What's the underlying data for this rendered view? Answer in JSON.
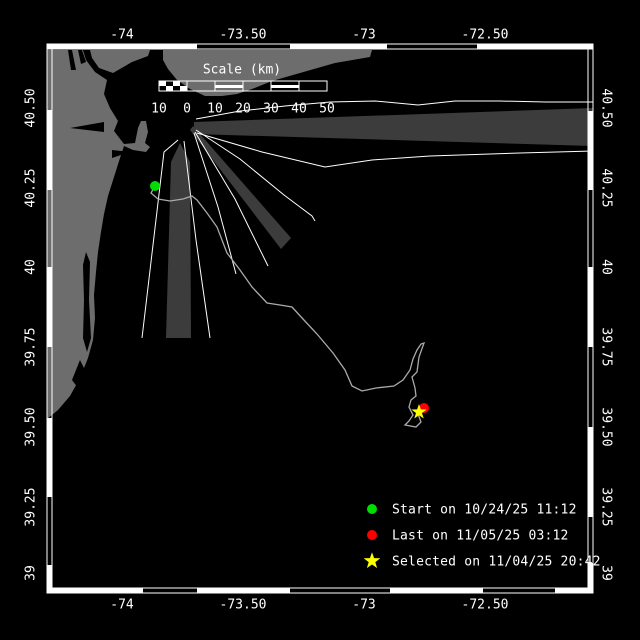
{
  "window": {
    "description": "Track map with radar coverage fan, scale bar and start/last/selected markers"
  },
  "colors": {
    "background": "#000000",
    "land": "#6d6d6d",
    "beam_gray": "#3c3c3c",
    "track_gray": "#aaaaaa",
    "frame_white": "#ffffff",
    "text_white": "#ffffff",
    "start_green": "#00dd00",
    "last_red": "#ff0000",
    "selected_yellow": "#ffff00"
  },
  "axes": {
    "lon_labels": [
      "-74",
      "-73.50",
      "-73",
      "-72.50"
    ],
    "lon_x": [
      122,
      243,
      364,
      485
    ],
    "lat_labels": [
      "40.50",
      "40.25",
      "40",
      "39.75",
      "39.50",
      "39.25",
      "39"
    ],
    "lat_y": [
      108,
      188,
      267,
      347,
      427,
      507,
      573
    ]
  },
  "scalebar": {
    "title": "Scale (km)",
    "tick_labels": [
      "10",
      "0",
      "10",
      "20",
      "30",
      "40",
      "50"
    ],
    "tick_x": [
      159,
      187,
      215,
      243,
      271,
      299,
      327
    ]
  },
  "legend": {
    "items": [
      {
        "marker": "start-dot",
        "color": "#00dd00",
        "label": "Start on 10/24/25 11:12"
      },
      {
        "marker": "last-dot",
        "color": "#ff0000",
        "label": "Last on 11/05/25 03:12"
      },
      {
        "marker": "selected-star",
        "color": "#ffff00",
        "label": "Selected on 11/04/25 20:42"
      }
    ]
  },
  "markers": {
    "start": {
      "x": 155,
      "y": 186
    },
    "last": {
      "x": 424,
      "y": 408
    },
    "selected": {
      "x": 419,
      "y": 412
    }
  },
  "track": {
    "points": [
      [
        155,
        186
      ],
      [
        151,
        193
      ],
      [
        158,
        199
      ],
      [
        170,
        201
      ],
      [
        183,
        199
      ],
      [
        192,
        196
      ],
      [
        197,
        200
      ],
      [
        207,
        213
      ],
      [
        217,
        227
      ],
      [
        227,
        253
      ],
      [
        240,
        270
      ],
      [
        252,
        287
      ],
      [
        267,
        303
      ],
      [
        280,
        305
      ],
      [
        292,
        307
      ],
      [
        303,
        319
      ],
      [
        317,
        334
      ],
      [
        333,
        353
      ],
      [
        345,
        370
      ],
      [
        352,
        386
      ],
      [
        362,
        391
      ],
      [
        376,
        388
      ],
      [
        394,
        386
      ],
      [
        403,
        380
      ],
      [
        410,
        370
      ],
      [
        413,
        359
      ],
      [
        417,
        350
      ],
      [
        421,
        344
      ],
      [
        424,
        343
      ],
      [
        419,
        357
      ],
      [
        417,
        372
      ],
      [
        412,
        377
      ],
      [
        415,
        388
      ],
      [
        416,
        396
      ],
      [
        411,
        400
      ],
      [
        409,
        407
      ],
      [
        413,
        415
      ],
      [
        409,
        421
      ],
      [
        405,
        425
      ],
      [
        416,
        427
      ],
      [
        421,
        422
      ],
      [
        418,
        414
      ],
      [
        424,
        408
      ]
    ]
  }
}
